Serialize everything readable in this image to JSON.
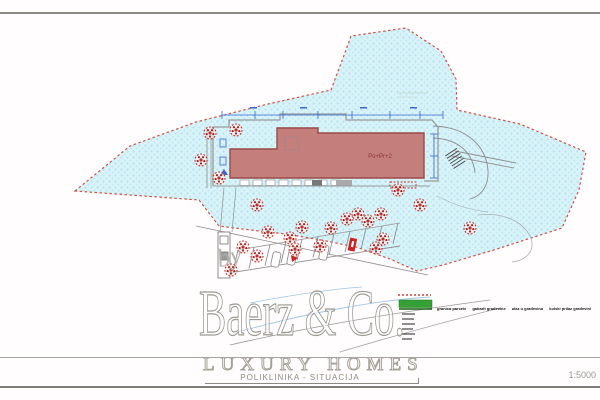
{
  "title_block": {
    "drawing_title": "POLIKLINIKA - SITUACIJA",
    "scale": "1:5000"
  },
  "watermark": {
    "by": "by",
    "brand": "Baerz & Co.",
    "tagline": "LUXURY HOMES"
  },
  "plan": {
    "building_label": "Po+Pr+2",
    "legend": {
      "items": [
        {
          "symbol": "red-dashed-line",
          "color": "#cc4433",
          "label": "granica parcele"
        },
        {
          "symbol": "green-bar",
          "color": "#35a035",
          "label": "gabarit građevine"
        },
        {
          "symbol": "entrance-mark",
          "color": "#111111",
          "label": "ulaz u građevinu"
        },
        {
          "symbol": "access-mark",
          "color": "#111111",
          "label": "kolski prilaz građevini"
        }
      ]
    },
    "colors": {
      "parcel_fill": "#d8f3f9",
      "parcel_dots": "#b7e3ec",
      "parcel_boundary": "#d05040",
      "building_fill": "#c47e7c",
      "building_stroke": "#9a4a46",
      "building_text": "#8b3434",
      "tree": "#c23128",
      "dimension_blue": "#3b66cc",
      "road_gray": "#8f8f8f",
      "legend_green": "#35a035"
    },
    "trees": [
      [
        210,
        133
      ],
      [
        236,
        130
      ],
      [
        201,
        160
      ],
      [
        219,
        178
      ],
      [
        257,
        205
      ],
      [
        268,
        232
      ],
      [
        243,
        247
      ],
      [
        257,
        256
      ],
      [
        290,
        238
      ],
      [
        302,
        227
      ],
      [
        295,
        249
      ],
      [
        320,
        246
      ],
      [
        331,
        228
      ],
      [
        347,
        219
      ],
      [
        358,
        214
      ],
      [
        368,
        221
      ],
      [
        381,
        214
      ],
      [
        383,
        239
      ],
      [
        376,
        248
      ],
      [
        398,
        190
      ],
      [
        420,
        205
      ],
      [
        470,
        228
      ],
      [
        231,
        270
      ]
    ]
  }
}
